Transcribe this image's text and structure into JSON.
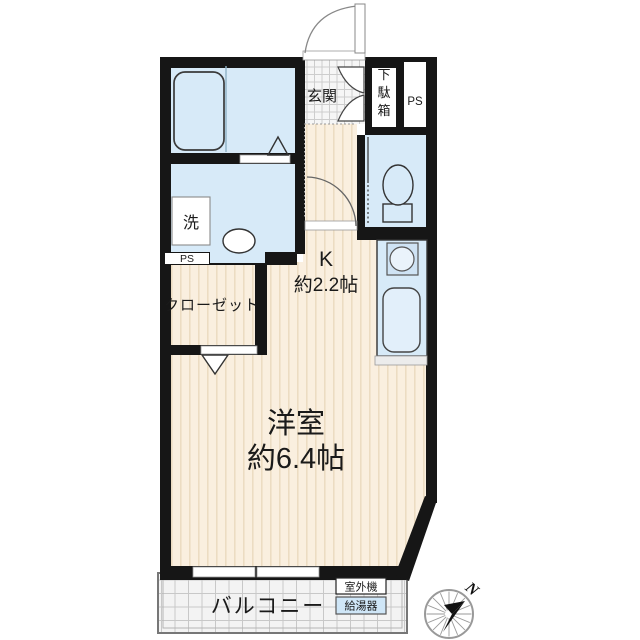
{
  "document": {
    "type": "apartment-floor-plan"
  },
  "colors": {
    "wall": "#161616",
    "wet_room_fill": "#d7eaf8",
    "floor_fill": "#faefdf",
    "floor_stripe": "#ecdcc2",
    "entrance_tile_fill": "#f6f6f6",
    "balcony_fill": "#f3f3f3",
    "water_heater_fill": "#cfe6f7"
  },
  "rooms": {
    "entrance": {
      "label": "玄関"
    },
    "shoe_cabinet": {
      "label": "下駄箱",
      "chars": [
        "下",
        "駄",
        "箱"
      ]
    },
    "pipe_space_top": {
      "label": "PS"
    },
    "pipe_space_side": {
      "label": "PS"
    },
    "laundry_machine": {
      "label": "洗"
    },
    "closet": {
      "label": "クローゼット"
    },
    "kitchen": {
      "label": "K",
      "size": "約2.2帖"
    },
    "main_room": {
      "label": "洋室",
      "size": "約6.4帖"
    },
    "balcony": {
      "label": "バルコニー"
    },
    "outdoor_ac_unit": {
      "label": "室外機"
    },
    "water_heater": {
      "label": "給湯器"
    }
  },
  "compass": {
    "north": "N"
  }
}
